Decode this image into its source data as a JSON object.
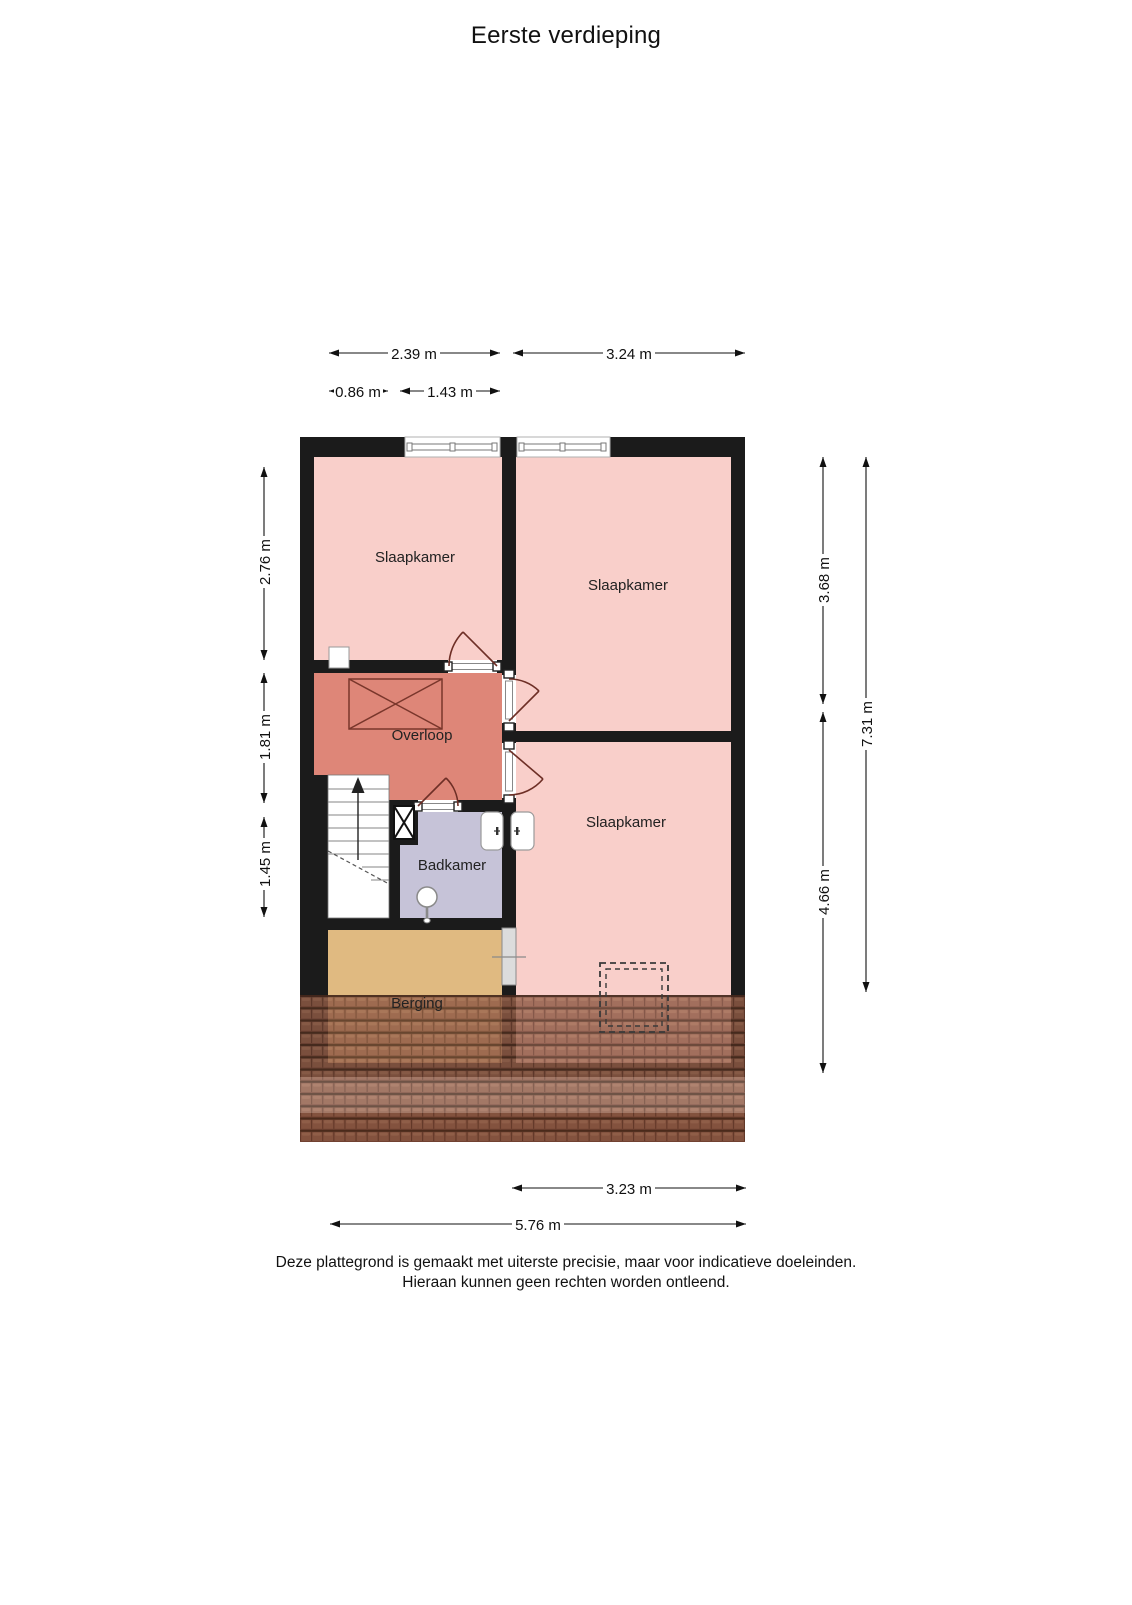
{
  "title": "Eerste verdieping",
  "footer": {
    "line1": "Deze plattegrond is gemaakt met uiterste precisie, maar voor indicatieve doeleinden.",
    "line2": "Hieraan kunnen geen rechten worden ontleend."
  },
  "rooms": {
    "bedroom_left": {
      "label": "Slaapkamer"
    },
    "bedroom_top_right": {
      "label": "Slaapkamer"
    },
    "bedroom_bottom_right": {
      "label": "Slaapkamer"
    },
    "landing": {
      "label": "Overloop"
    },
    "bathroom": {
      "label": "Badkamer"
    },
    "storage": {
      "label": "Berging"
    }
  },
  "dimensions": {
    "top": [
      {
        "label": "2.39 m"
      },
      {
        "label": "3.24 m"
      },
      {
        "label": "0.86 m"
      },
      {
        "label": "1.43 m"
      }
    ],
    "left": [
      {
        "label": "2.76 m"
      },
      {
        "label": "1.81 m"
      },
      {
        "label": "1.45 m"
      }
    ],
    "right": [
      {
        "label": "3.68 m"
      },
      {
        "label": "4.66 m"
      },
      {
        "label": "7.31 m"
      }
    ],
    "bottom": [
      {
        "label": "3.23 m"
      },
      {
        "label": "5.76 m"
      }
    ]
  },
  "palette": {
    "bedroom": "#f9cfca",
    "landing": "#de8678",
    "bathroom": "#c6c3d8",
    "storage": "#e0ba81",
    "wall": "#1b1b1b",
    "roof_tile": "#8f5a45",
    "dimension": "#111111"
  }
}
